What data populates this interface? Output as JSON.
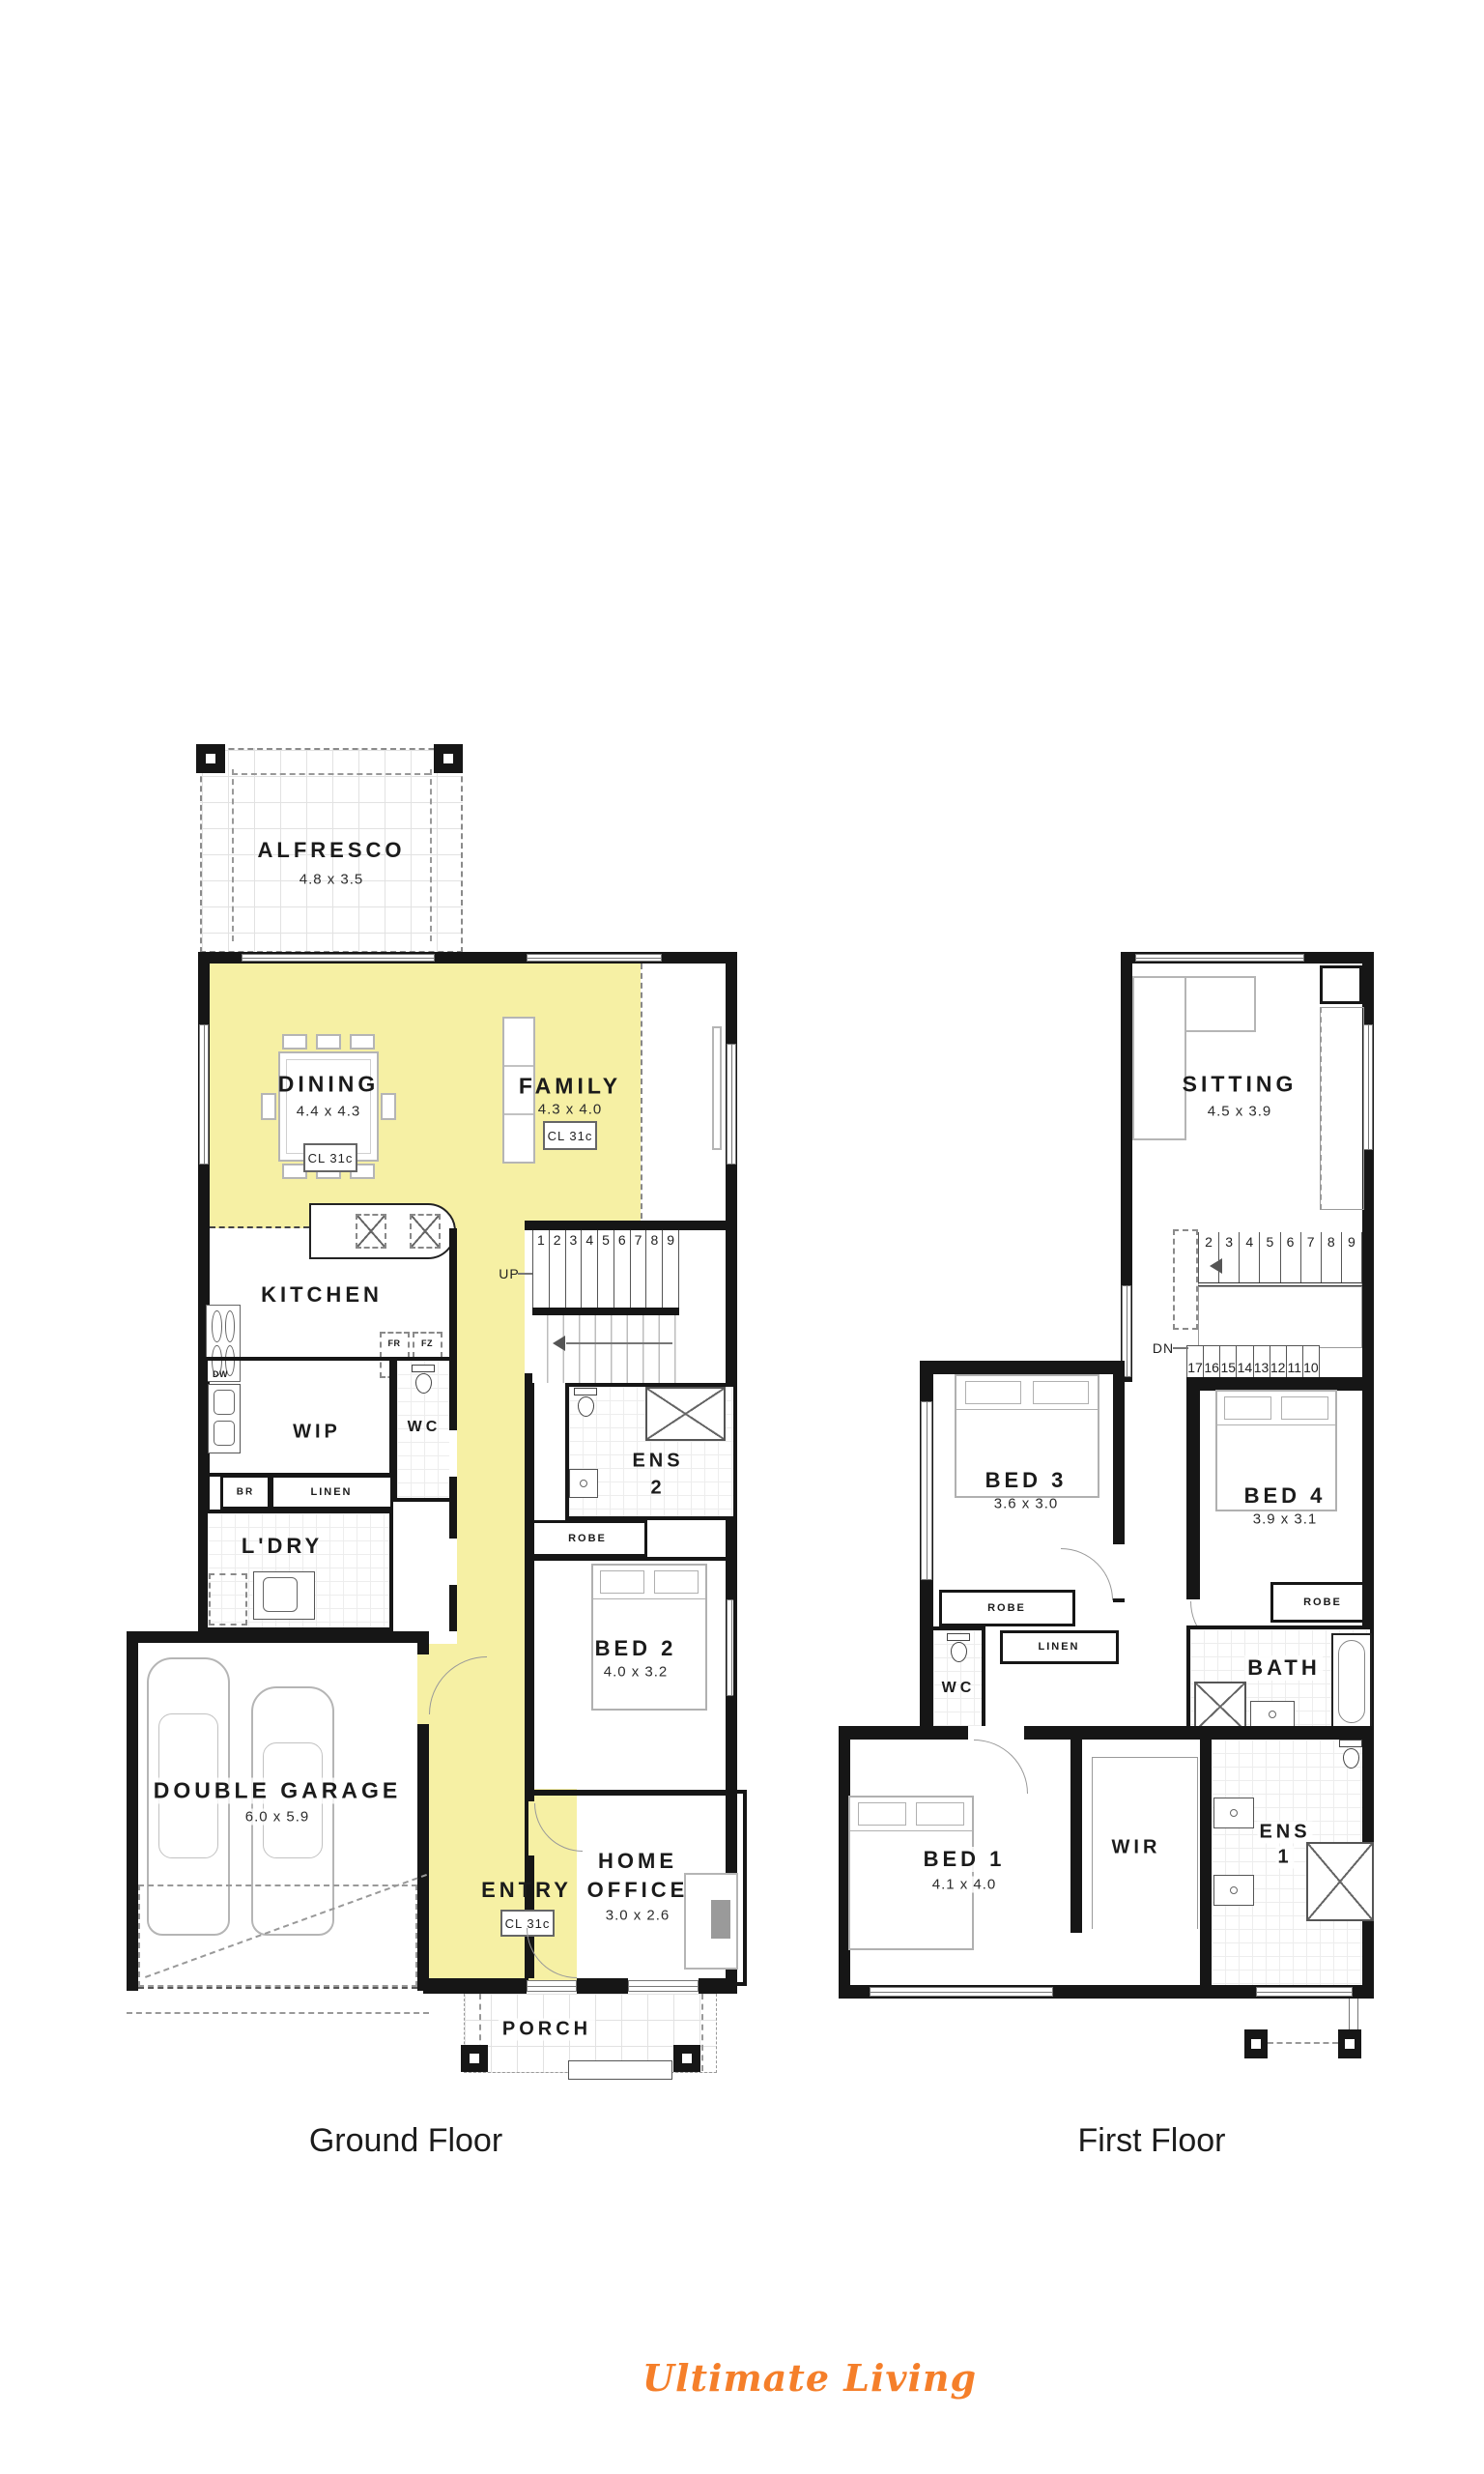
{
  "colors": {
    "highlight": "#F6F0A4",
    "wall": "#161616",
    "logo_orange": "#F57F2A"
  },
  "ground_floor": {
    "caption": "Ground Floor",
    "alfresco": {
      "name": "ALFRESCO",
      "dims": "4.8 x 3.5"
    },
    "dining": {
      "name": "DINING",
      "dims": "4.4 x 4.3",
      "ceiling": "CL 31c"
    },
    "family": {
      "name": "FAMILY",
      "dims": "4.3 x 4.0",
      "ceiling": "CL 31c"
    },
    "kitchen": {
      "name": "KITCHEN"
    },
    "appliances": {
      "fridge": "FR",
      "freezer": "FZ",
      "dishwasher": "DW"
    },
    "wip": {
      "name": "WIP"
    },
    "wc": {
      "name": "WC"
    },
    "broom": {
      "name": "BR"
    },
    "linen": {
      "name": "LINEN"
    },
    "laundry": {
      "name": "L'DRY"
    },
    "stairs": {
      "direction": "UP",
      "numbers": [
        "1",
        "2",
        "3",
        "4",
        "5",
        "6",
        "7",
        "8",
        "9"
      ]
    },
    "ens2": {
      "line1": "ENS",
      "line2": "2"
    },
    "robe": {
      "name": "ROBE"
    },
    "bed2": {
      "name": "BED 2",
      "dims": "4.0 x 3.2"
    },
    "garage": {
      "name": "DOUBLE GARAGE",
      "dims": "6.0 x 5.9"
    },
    "entry": {
      "name": "ENTRY",
      "ceiling": "CL 31c"
    },
    "home_office": {
      "line1": "HOME",
      "line2": "OFFICE",
      "dims": "3.0 x 2.6"
    },
    "porch": {
      "name": "PORCH"
    }
  },
  "first_floor": {
    "caption": "First Floor",
    "sitting": {
      "name": "SITTING",
      "dims": "4.5 x 3.9"
    },
    "stairs": {
      "direction": "DN",
      "upper_numbers": [
        "2",
        "3",
        "4",
        "5",
        "6",
        "7",
        "8",
        "9"
      ],
      "lower_numbers": [
        "17",
        "16",
        "15",
        "14",
        "13",
        "12",
        "11",
        "10"
      ]
    },
    "bed3": {
      "name": "BED 3",
      "dims": "3.6 x 3.0"
    },
    "bed4": {
      "name": "BED 4",
      "dims": "3.9 x 3.1"
    },
    "robe_bed3": {
      "name": "ROBE"
    },
    "robe_bed4": {
      "name": "ROBE"
    },
    "linen": {
      "name": "LINEN"
    },
    "wc": {
      "name": "WC"
    },
    "bath": {
      "name": "BATH"
    },
    "ens1": {
      "line1": "ENS",
      "line2": "1"
    },
    "wir": {
      "name": "WIR"
    },
    "bed1": {
      "name": "BED 1",
      "dims": "4.1 x 4.0"
    }
  },
  "footer": {
    "logo": "Ultimate Living"
  }
}
